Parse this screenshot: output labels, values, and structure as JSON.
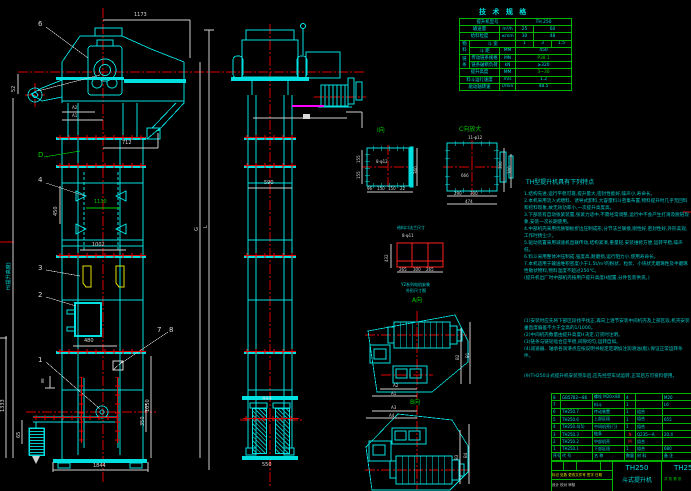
{
  "colors": {
    "background": "#000000",
    "line_cyan": "#00e0e0",
    "dim_white": "#d9d9d9",
    "center_red": "#ff0000",
    "table_green": "#00b400",
    "accent_green": "#00d000",
    "bucket_yellow": "#e0e000",
    "motor_magenta": "#ff00ff"
  },
  "spec_table": {
    "title": "技 术 规 格",
    "model_label": "提升机型号",
    "model_value": "TH 250",
    "cap_label": "输送量",
    "cap_unit": "m³/h",
    "cap_v1": "25",
    "cap_v2": "60",
    "gran_label": "给料粒度",
    "gran_unit": "≤mm",
    "gran_v1": "30",
    "gran_v2": "48",
    "mat_label": "物料",
    "width_label": "斗 宽",
    "w1": "1",
    "w2": "3",
    "w3": "1.5",
    "pitch_label": "斗 距",
    "pitch_unit": "MM",
    "pitch_value": "450",
    "chain_label": "链条",
    "chain_spec_label": "传动链条规格",
    "chain_spec_unit": "MN",
    "chain_spec_value": "P38.1",
    "break_label": "链条破断负荷",
    "break_unit": "kN",
    "break_value": "≥320",
    "height_label": "提升高度",
    "height_unit": "MM",
    "height_value": "3~30",
    "speed_label": "料斗运行速度",
    "speed_unit": "m/s",
    "speed_value": "1.2",
    "rpm_label": "驱动轴转速",
    "rpm_unit": "r/min",
    "rpm_value": "48.5"
  },
  "notes": {
    "heading": "TH型提升机具有下列特点",
    "lines1": [
      "1.结构先进,运行平稳可靠,提升量大,密封性能好,噪声小,寿命长。",
      "2.本机采用流入式喂料、诱导式卸料,大容量料斗密集布置,物料提升时几乎无回料和挖料现象,故无效功率小,一次提升高度高。",
      "3.下部装有自动张紧装置,张紧力适中,不需经常调整,运行中不会产生打滑及脱链现象,安装一次长期使用。",
      "4.中部机壳采用优质钢板折边压制成形,分节法兰联接,刚性好,密封性好,外形美观,工作时扬尘少。",
      "5.驱动装置采用减速机直联传动,结构紧凑,重量轻,安装维修方便,运转平稳,噪声低。",
      "6.料斗采用整体冲压制成,强度高,耐磨损,运行阻力小,使用寿命长。",
      "7.本机适用于输送堆积密度小于1.5t/m³的粉状、粒状、小块状无磨琢性及半磨琢性散状物料,物料温度不超过250℃。",
      "(提升机出厂时中部机壳按用户提升高度H配置,分件包装供货。)"
    ],
    "lines2": [
      "(1)安装时应先将下部区段找平找正,再向上逐节安装中间机壳及上部区段,机壳安装垂直度偏差不大于全高的1/1000。",
      "(2)中间机壳数量由提升高度H决定,订货时注明。",
      "(3)链条与链轮啮合应平稳,间隙均匀,运转自如。",
      "(4)减速器、轴承各润滑点应按说明书规定定期加注润滑油(脂),保证正常运转条件。"
    ],
    "line9": "(9)TH250斗式提升机安装完毕后,应先经空车试运转,正常后方可投料使用。"
  },
  "bom": {
    "headers": [
      "序号",
      "代  号",
      "名  称",
      "数量",
      "材  料",
      "备 注"
    ],
    "rows": [
      {
        "no": "8",
        "code": "GB5782—86",
        "name": "螺栓 M20×80",
        "qty": "4",
        "mat": "",
        "note": "M20"
      },
      {
        "no": "7",
        "code": "",
        "name": "料斗",
        "qty": "1",
        "mat": "",
        "note": "L6"
      },
      {
        "no": "6",
        "code": "TH250.7",
        "name": "传动装置",
        "qty": "1",
        "mat": "组合",
        "note": ""
      },
      {
        "no": "5",
        "code": "TH250.6",
        "name": "上部区段",
        "qty": "1",
        "mat": "组合",
        "note": "655"
      },
      {
        "no": "4",
        "code": "TH250.4(5)",
        "name": "中间机壳(门)",
        "qty": "1",
        "mat": "组合",
        "note": ""
      },
      {
        "no": "3",
        "code": "TH250.3",
        "name": "链条",
        "qty": "N",
        "mat": "Q235—A",
        "note": "20.4"
      },
      {
        "no": "2",
        "code": "TH250.2",
        "name": "中部机壳",
        "qty": "M",
        "mat": "组合",
        "note": ""
      },
      {
        "no": "1",
        "code": "TH250.1",
        "name": "下部区段",
        "qty": "1",
        "mat": "组合",
        "note": "680"
      }
    ]
  },
  "title_block": {
    "model": "TH250",
    "product_name": "斗式提升机",
    "drawing_code": "TH250",
    "stage": "共 张 第 张",
    "revision_row": "标记 处数 更改文件号 签字 日期",
    "sign_row": "设计  校对  审核"
  },
  "labels": {
    "dim_1173": "1173",
    "callout_6": "6",
    "dim_52": "52",
    "dim_a2": "A2",
    "dim_a1": "A1",
    "dim_712": "712",
    "callout_d": "D",
    "callout_4": "4",
    "dim_450": "450",
    "dim_1130": "1130",
    "dim_1002": "1002",
    "dim_h": "H(提升高度)",
    "dim_g": "G",
    "dim_l": "L",
    "callout_3": "3",
    "callout_2": "2",
    "callout_7": "7",
    "callout_8": "8",
    "callout_1": "1",
    "section_ii": "Ⅱ",
    "dim_480": "480",
    "dim_1333": "1333",
    "dim_65": "65",
    "dim_1050": "1050",
    "dim_350": "350",
    "dim_1844": "1844",
    "dim_590": "590",
    "dim_444": "444",
    "dim_550": "550",
    "view_i": "Ⅰ向",
    "dim_8x12": "8-φ12",
    "dim_155a": "155",
    "dim_155b": "155",
    "dim_360": "360",
    "dim_96": "96",
    "dim_150a": "150",
    "dim_150b": "150",
    "dim_22": "22",
    "view_c": "C向放大",
    "dim_11x12": "11-φ12",
    "dim_666": "666",
    "dim_300a": "300",
    "dim_300b": "300",
    "dim_290": "290",
    "dim_300c": "300",
    "dim_474": "474",
    "feed_title": "给料口法兰尺寸",
    "dim_8x11": "8-φ11",
    "dim_432": "432",
    "dim_265a": "265",
    "dim_300d": "300",
    "dim_265b": "265",
    "motor_note1": "Y2系列电机安装",
    "motor_note2": "外形尺寸图",
    "view_a": "A向",
    "dim_a2b": "A2",
    "dim_a1b": "A1",
    "dim_b2": "B2",
    "dim_b1": "B1",
    "view_b": "B向",
    "dim_a3": "A3",
    "dim_a4": "A4",
    "dim_b3": "B3",
    "dim_b4": "B4"
  }
}
